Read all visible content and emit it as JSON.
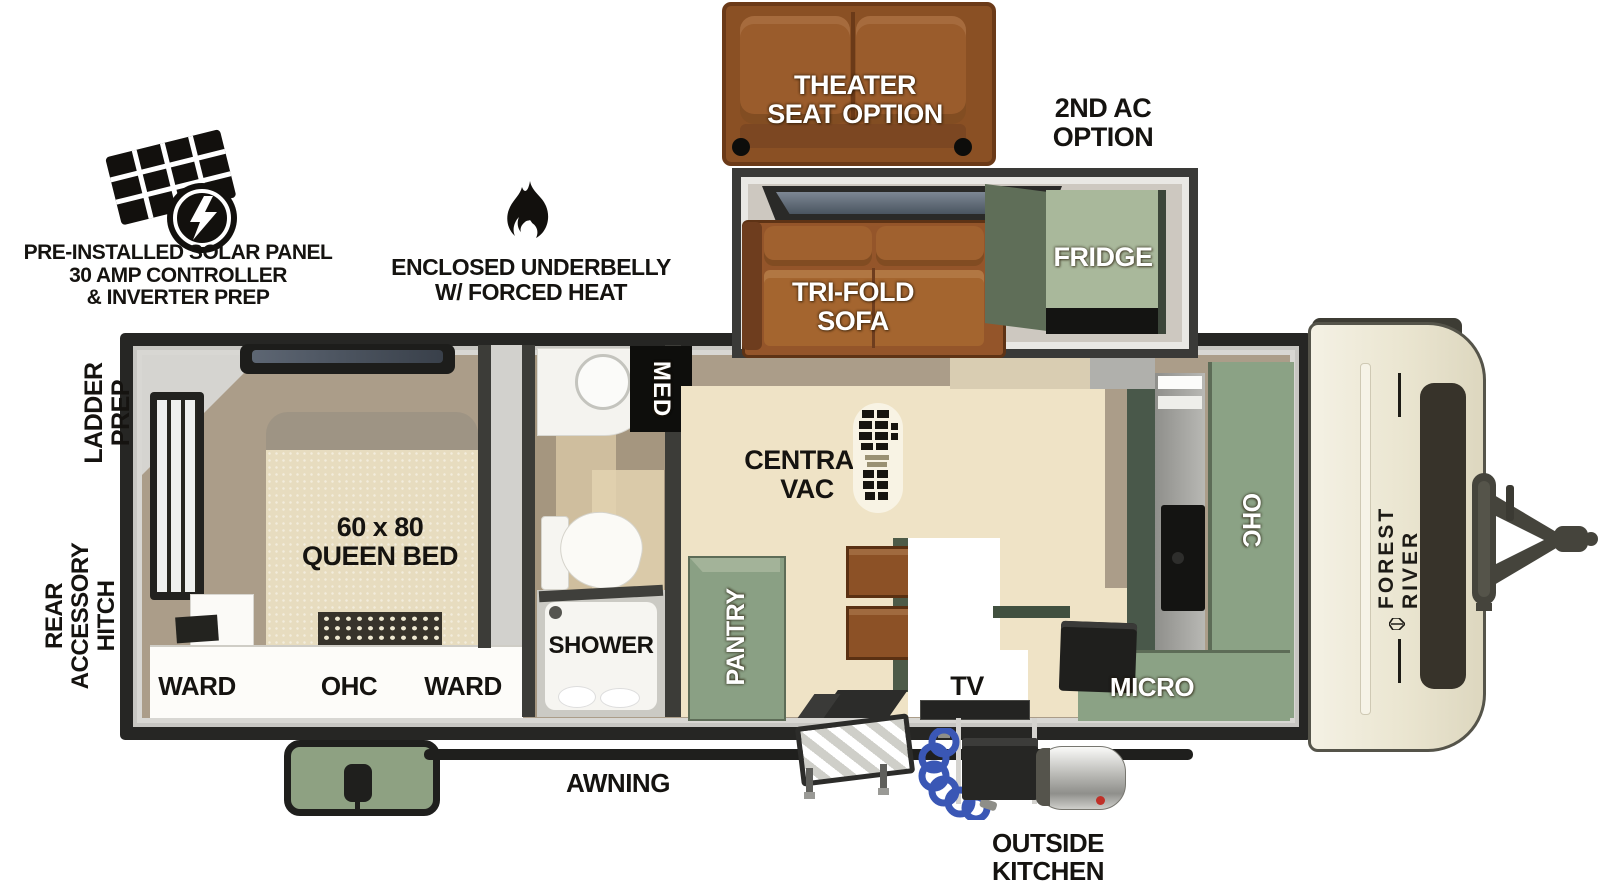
{
  "callouts": {
    "solar": "PRE-INSTALLED SOLAR PANEL\n30 AMP CONTROLLER\n& INVERTER PREP",
    "underbelly": "ENCLOSED UNDERBELLY\nW/ FORCED HEAT",
    "theater_seat": "THEATER\nSEAT OPTION",
    "second_ac": "2ND AC\nOPTION",
    "ladder_prep": "LADDER\nPREP",
    "rear_accessory_hitch": "REAR\nACCESSORY\nHITCH",
    "awning": "AWNING",
    "outside_kitchen": "OUTSIDE\nKITCHEN"
  },
  "labels": {
    "fridge": "FRIDGE",
    "tri_fold_sofa": "TRI-FOLD\nSOFA",
    "central_vac": "CENTRAL\nVAC",
    "pantry": "PANTRY",
    "tv": "TV",
    "micro": "MICRO",
    "kitchen_ohc": "OHC",
    "med": "MED",
    "shower": "SHOWER",
    "queen_bed": "60 x 80\nQUEEN BED",
    "ward_left": "WARD",
    "bedroom_ohc": "OHC",
    "ward_right": "WARD"
  },
  "brand": "FOREST RIVER",
  "colors": {
    "cabinet_sage": "#8ba285",
    "cabinet_sage_light": "#a9b89b",
    "cabinet_sage_dark": "#49584a",
    "sofa_brown": "#94552a",
    "theater_brown": "#8a5024",
    "floor_cream": "#efe3c6",
    "floor_taupe": "#ab9d89",
    "wall_dark": "#262624",
    "cap_cream": "#ece8d7",
    "hose_blue": "#3a57b5"
  }
}
